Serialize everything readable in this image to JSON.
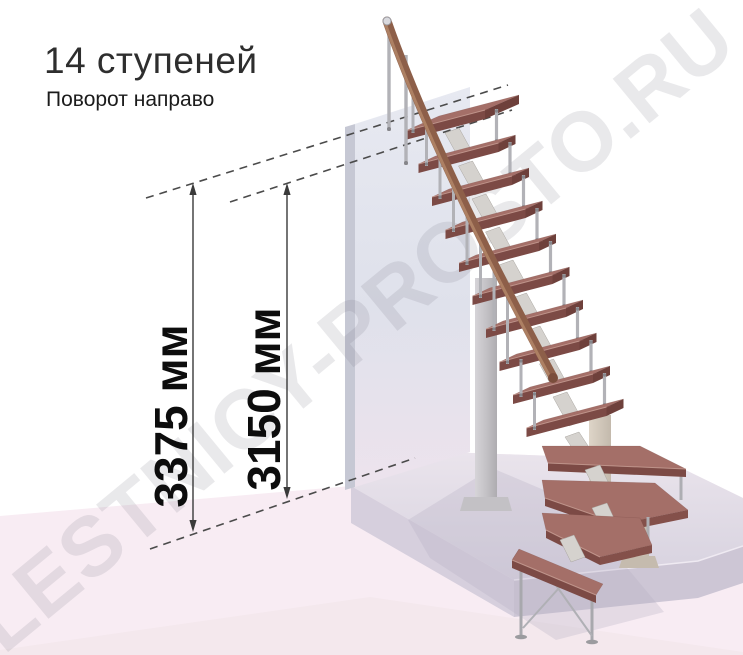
{
  "header": {
    "title": "14 ступеней",
    "subtitle": "Поворот направо"
  },
  "watermark": {
    "text": "LESTNICY-PROSTO.RU"
  },
  "diagram": {
    "type": "staircase-3d-illustration",
    "stair": {
      "steps_label": "14 ступеней",
      "turn_label": "Поворот направо",
      "straight_treads": 10,
      "winder_treads": 3,
      "bottom_treads": 1
    },
    "dimensions": [
      {
        "id": "overall-height",
        "label": "3375 мм"
      },
      {
        "id": "height-to-top-step",
        "label": "3150 мм"
      }
    ],
    "colors": {
      "tread_top": "#a46f68",
      "tread_front": "#7c4a45",
      "tread_side": "#6e403b",
      "nose_highlight": "#c79d93",
      "handrail": "#8d5f49",
      "handrail_light": "#bb8e6f",
      "baluster": "#b2b2b7",
      "bracket": "#d5d2ce",
      "wall_front": "#e2e4ed",
      "wall_edge": "#c6c8d4",
      "platform_top": "#ded9e4",
      "platform_front": "#cdc6d5",
      "floor_pink": "#f8ecf3",
      "support_beige": "#d3c9bc",
      "dimension_line": "#3a3a3a",
      "dashed_line": "#4b4b4b"
    }
  }
}
